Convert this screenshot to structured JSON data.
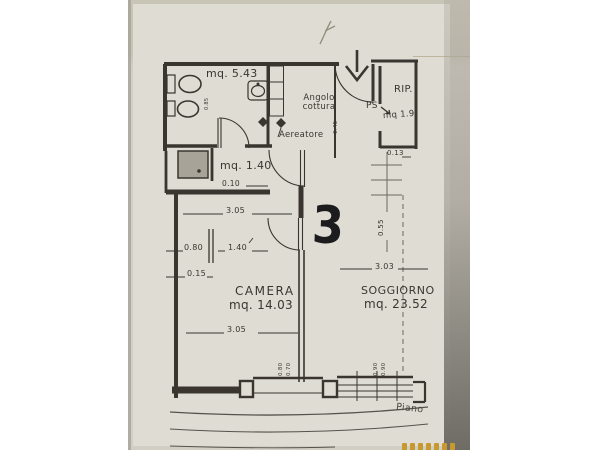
{
  "photo": {
    "description": "scanned floor plan photo",
    "handwriting": {
      "unit_number": "3"
    },
    "rooms": {
      "bathroom_area": "mq. 5.43",
      "kitchen_label": "Angolo cottura",
      "vent_label": "Aereatore",
      "closet_label": "RIP.",
      "closet_door": "PS",
      "closet_area": "mq 1.9",
      "hall_area": "mq. 1.40",
      "bedroom_name": "CAMERA",
      "bedroom_area": "mq. 14.03",
      "living_name": "SOGGIORNO",
      "living_area": "mq. 23.52",
      "floor_note": "Piano"
    },
    "dimensions": {
      "d010": "0.10",
      "d305_top": "3.05",
      "d080": "0.80",
      "d140": "1.40",
      "d015": "0.15",
      "d305_bottom": "3.05",
      "d013": "0.13",
      "d055": "0.55",
      "d303": "3.03",
      "bath_small": "0.85",
      "kitchen_small": "0.45",
      "balcony_door_a": "0.80",
      "balcony_door_b": "0.70",
      "window_a": "0.90",
      "window_b": "0.90"
    }
  },
  "colors": {
    "page": "#ffffff",
    "photo": "#d2cec4",
    "photo_top": "#c8c4b6",
    "paper": "#dfdcd4",
    "ink": "#3a362f",
    "ink_light": "#6c6860",
    "edge": "#a29e96",
    "shadow": "#6f6c65",
    "crease": "#b6ab90",
    "shaft": "#a7a399",
    "pencil": "#93907f",
    "stamp": "#c79a2f"
  }
}
